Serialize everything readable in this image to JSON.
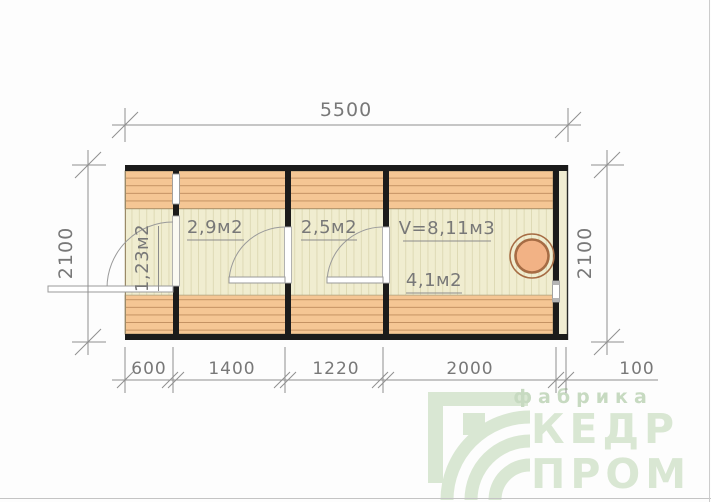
{
  "plan": {
    "title": "modular cabin floor plan",
    "dimensions": {
      "top_width": "5500",
      "left_height": "2100",
      "right_height": "2100",
      "bottom_segments": [
        "600",
        "1400",
        "1220",
        "2000",
        "100"
      ]
    },
    "rooms": [
      {
        "label": "1,23м2"
      },
      {
        "label": "2,9м2"
      },
      {
        "label": "2,5м2"
      },
      {
        "volume_label": "V=8,11м3",
        "area_label": "4,1м2"
      }
    ],
    "colors": {
      "wall": "#1b1b1b",
      "deck_orange": "#f5c694",
      "deck_orange_line": "#c29061",
      "floor_beige": "#f0edd0",
      "floor_beige_line": "#dcd8b2",
      "end_cream": "#f0ecd2",
      "dim_gray": "#8c8c8c",
      "stove_fill": "#f2b285",
      "stove_ring": "#a66c44"
    }
  },
  "watermark": {
    "tagline": "фабрика",
    "line1": "КЕДР",
    "line2": "ПРОМ",
    "color": "#d9e7d3",
    "tagline_color": "#c7dac1"
  }
}
